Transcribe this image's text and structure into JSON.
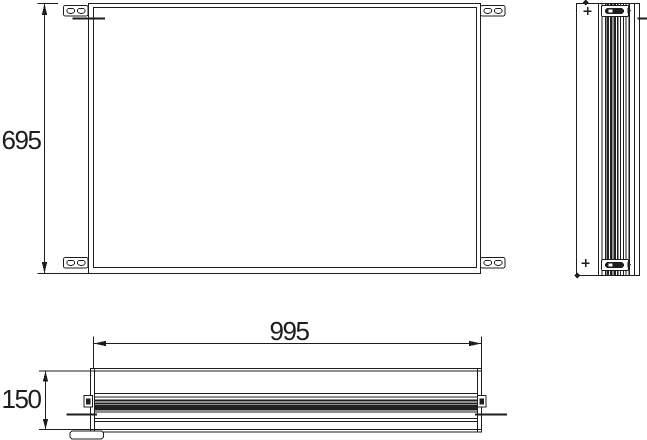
{
  "drawing": {
    "kind": "technical-drawing",
    "dimensions": {
      "height": "695",
      "width": "995",
      "depth": "150"
    },
    "colors": {
      "background": "#ffffff",
      "line": "#1d1d1d",
      "dark_fill": "#222222"
    }
  }
}
